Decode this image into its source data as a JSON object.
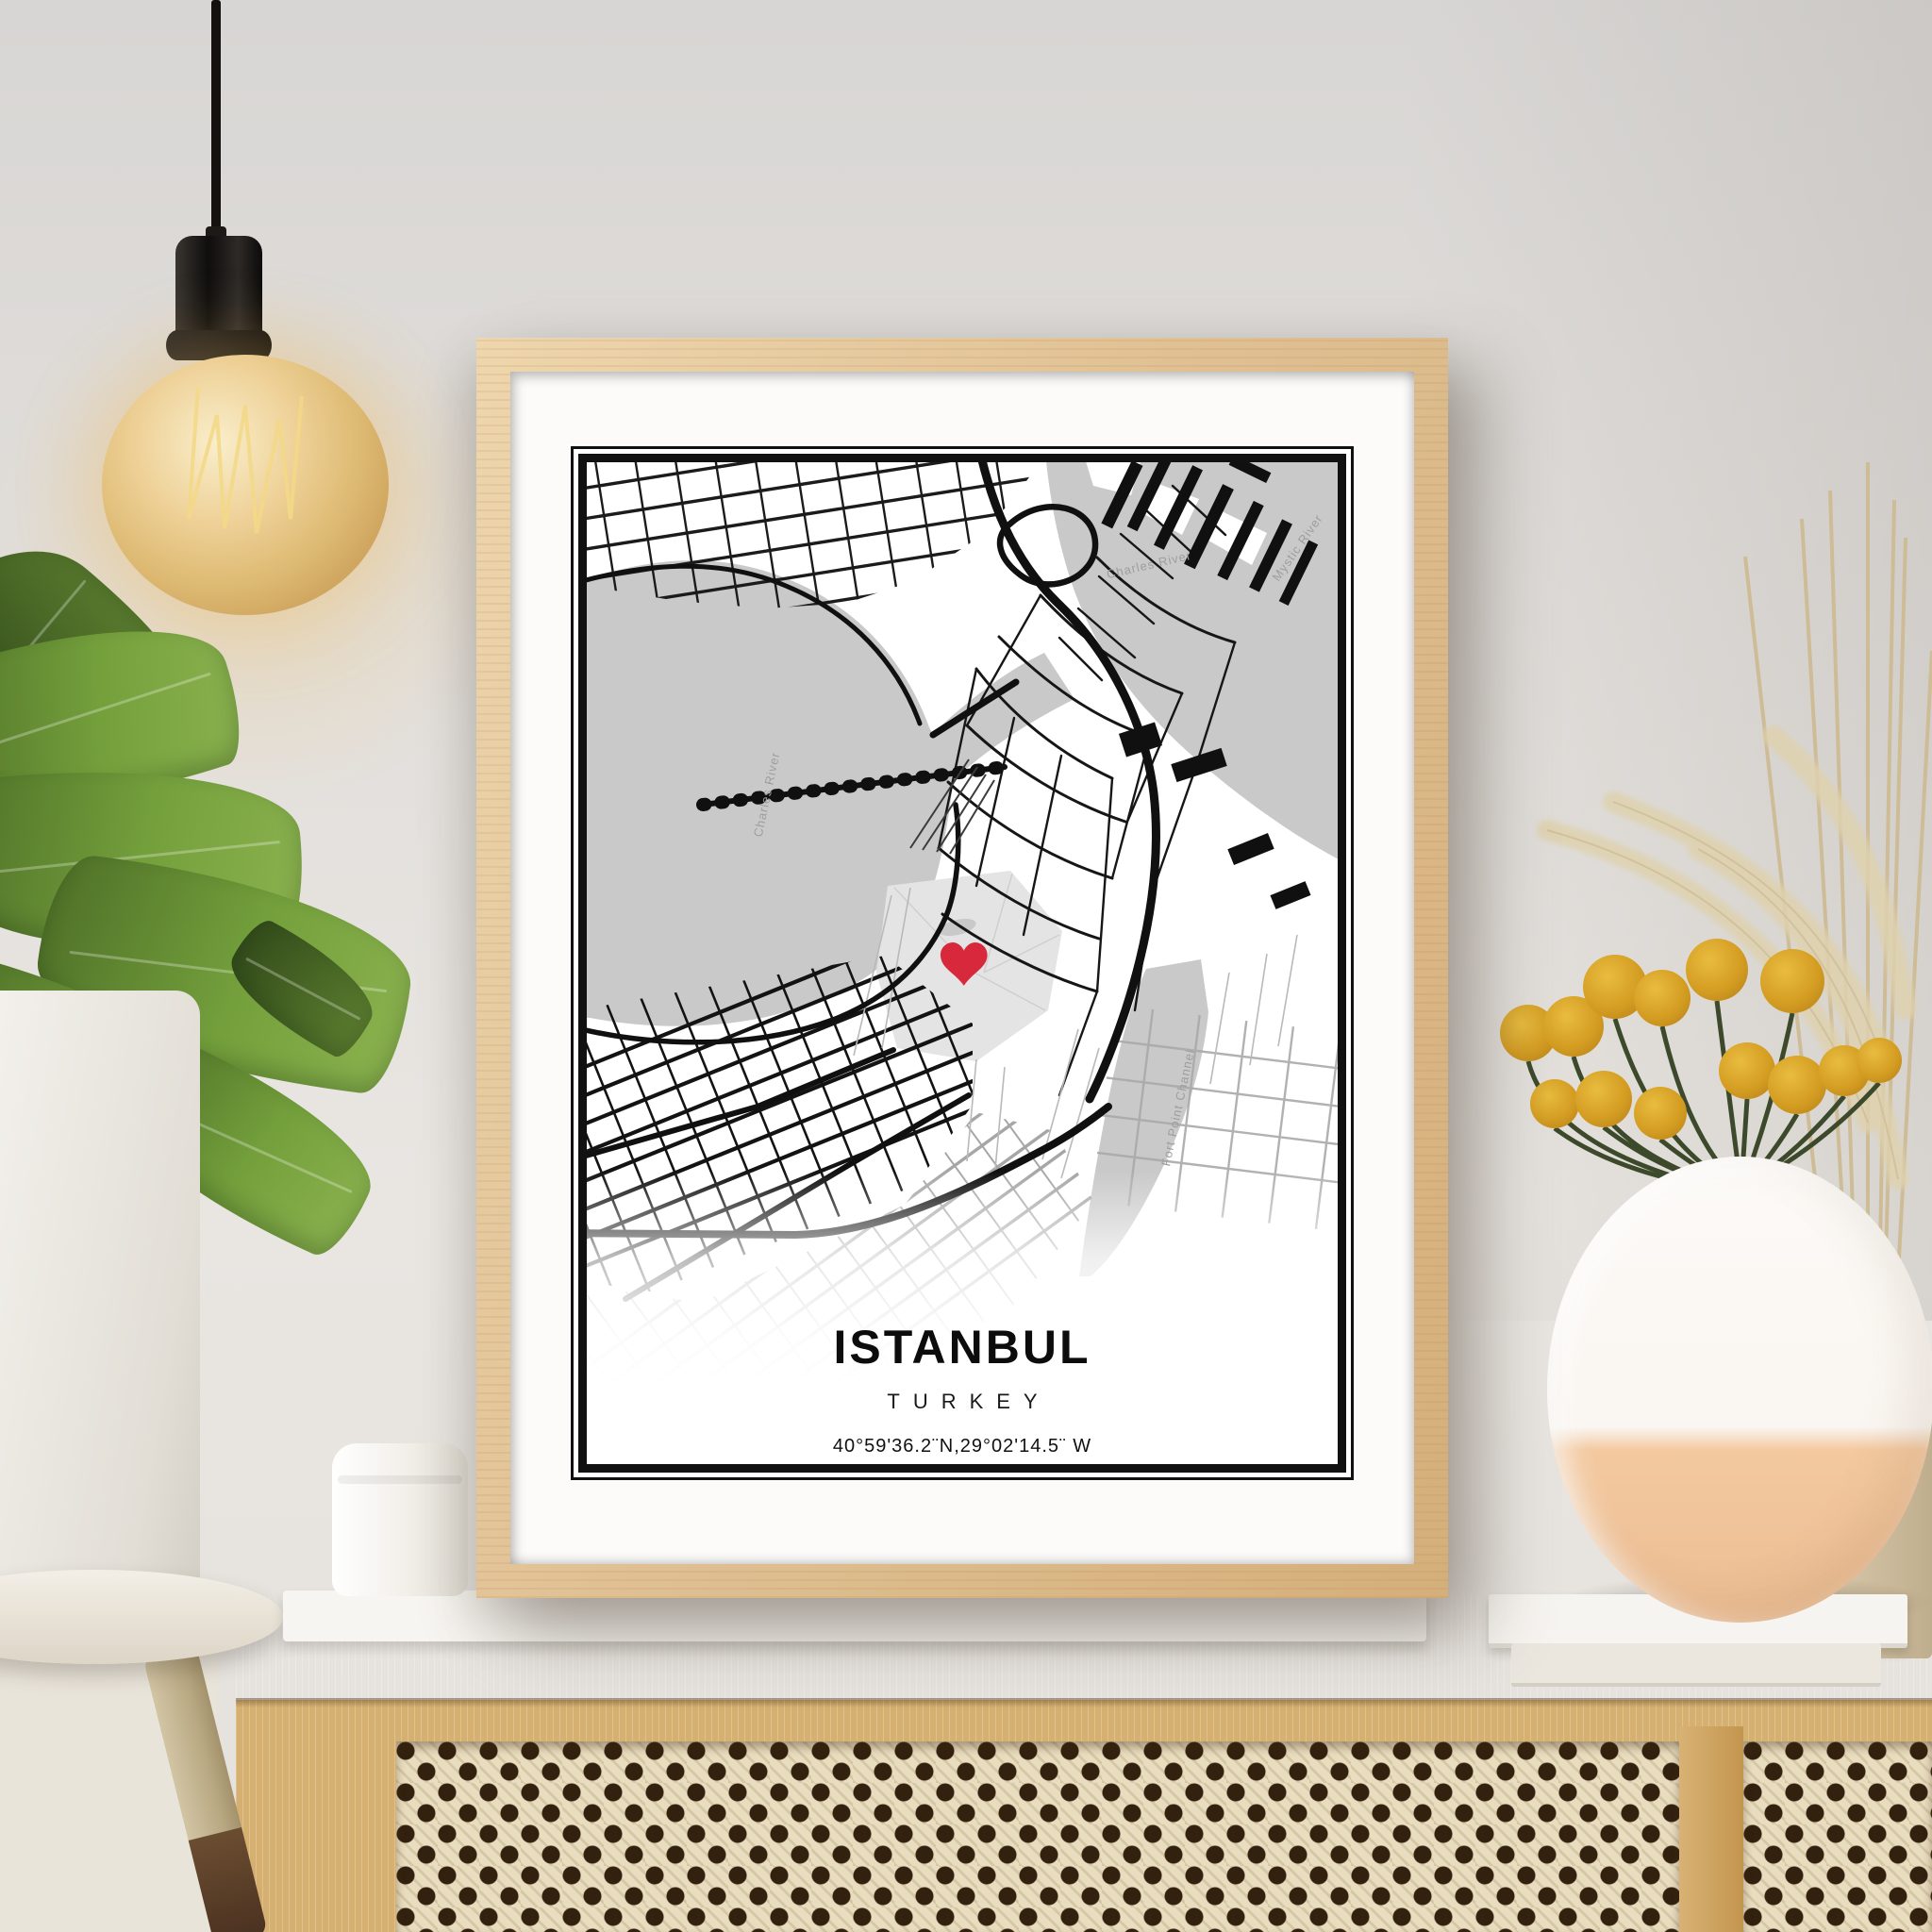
{
  "poster": {
    "title": "ISTANBUL",
    "country": "TURKEY",
    "coordinates": "40°59'36.2¨N,29°02'14.5¨ W"
  },
  "map_labels": {
    "charles_river": "Charles River",
    "charles_river_basin": "Charles River",
    "mystic_river": "Mystic River",
    "fort_point_channel": "Fort Point Channel"
  },
  "colors": {
    "heart_marker": "#d8283c",
    "map_water": "#c9c9c9",
    "frame_wood": "#e0c096",
    "wall": "#e4e1de",
    "cane_webbing": "#e9ddbf",
    "craspedia_yellow": "#d9a125"
  }
}
